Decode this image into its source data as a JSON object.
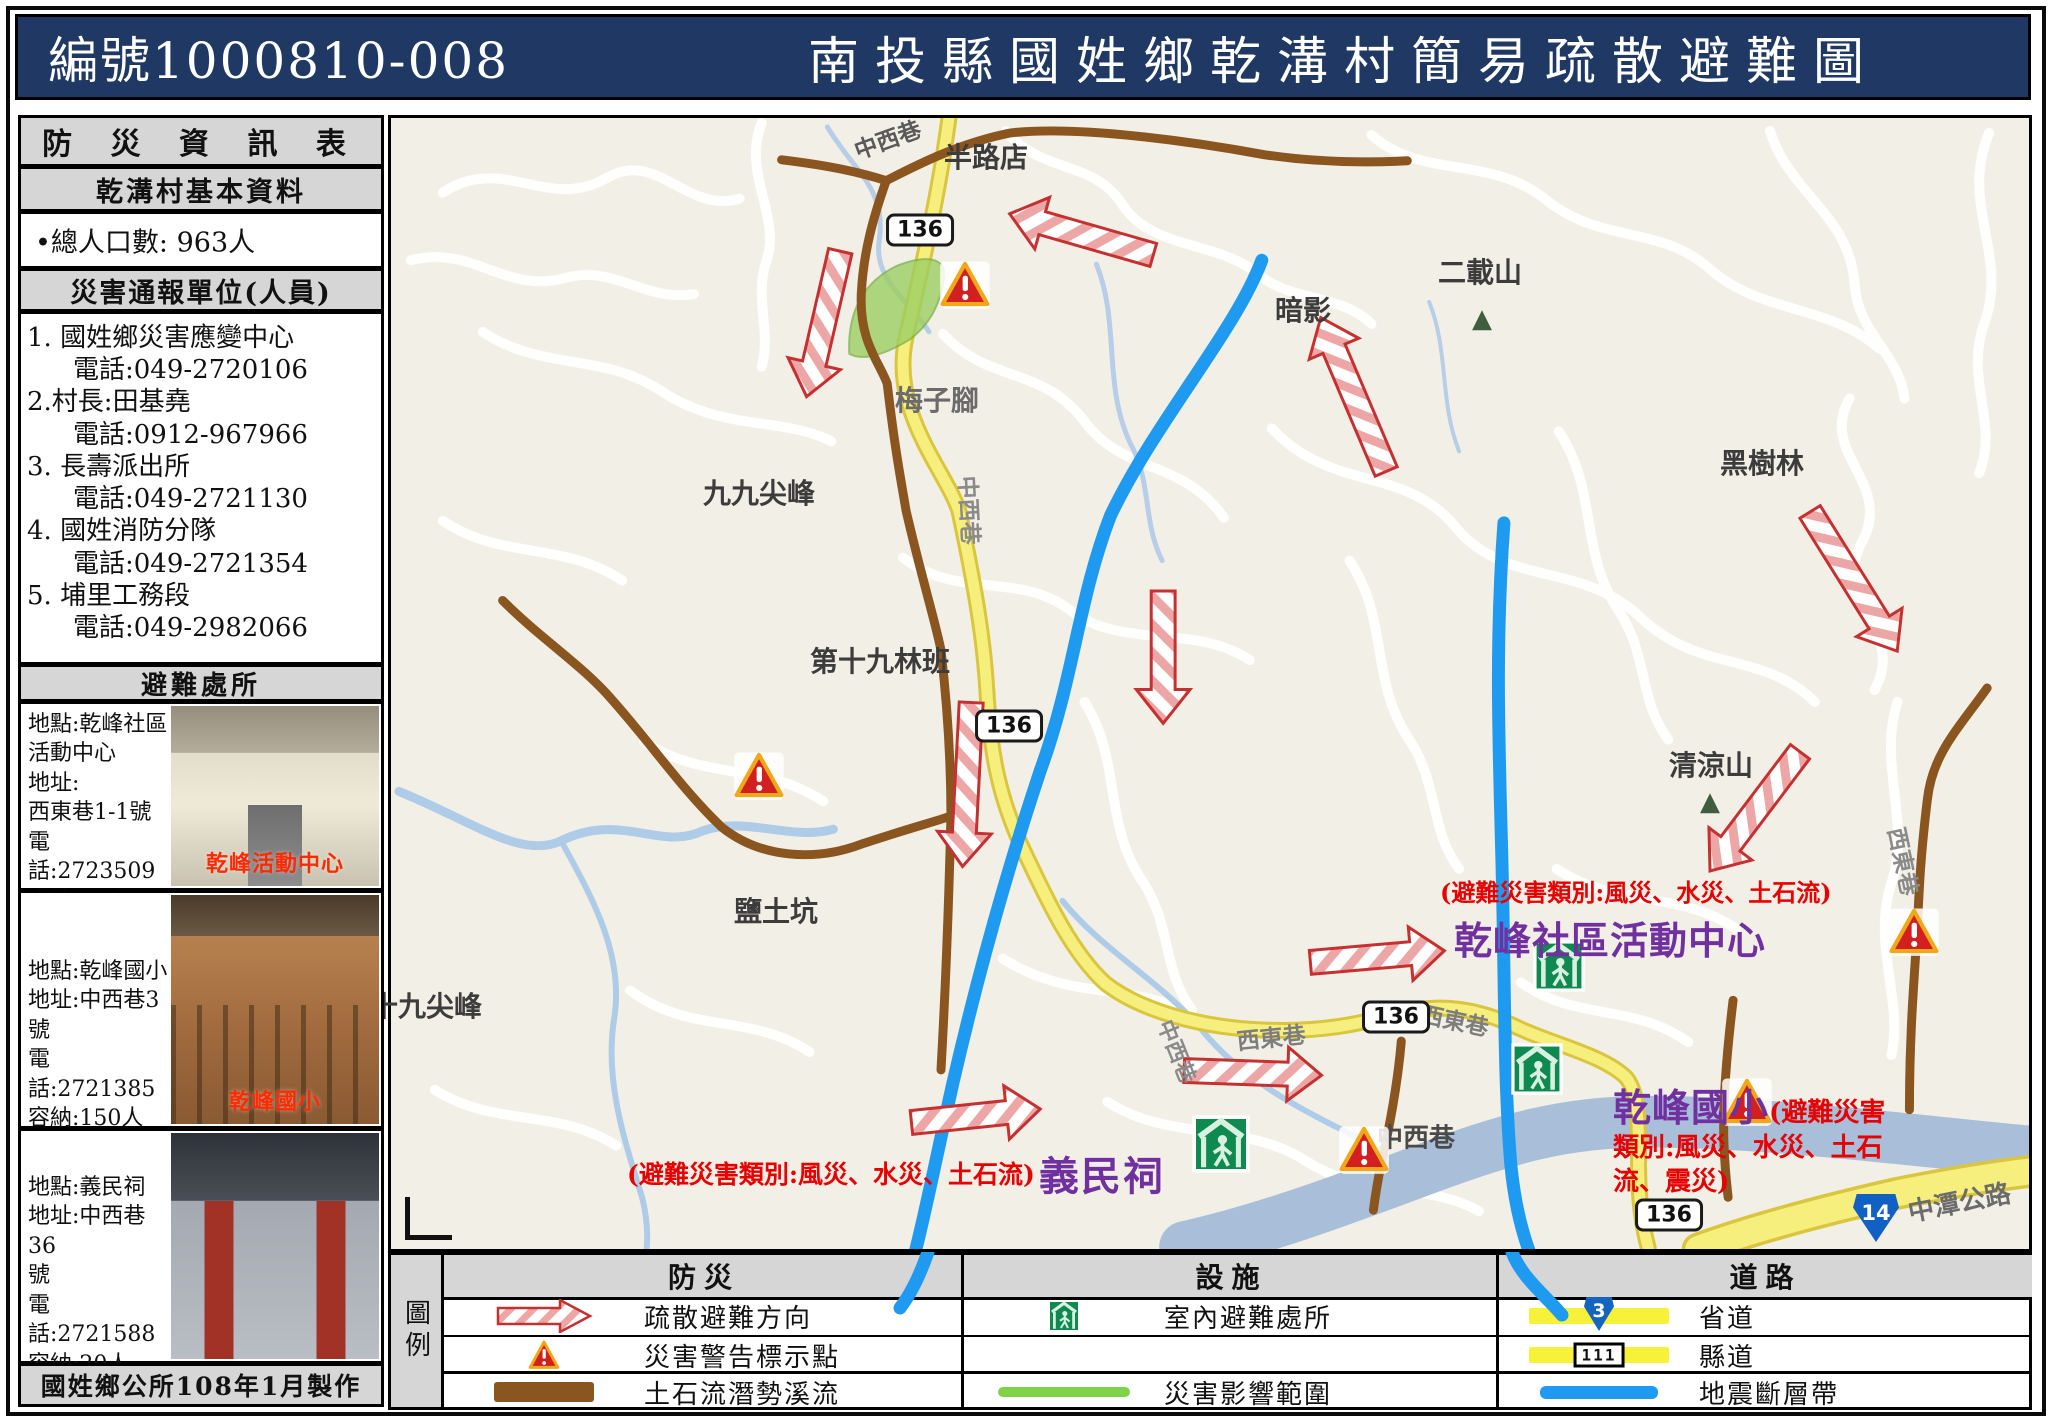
{
  "header": {
    "code": "編號1000810-008",
    "title": "南投縣國姓鄉乾溝村簡易疏散避難圖"
  },
  "sidebar": {
    "title": "防 災 資 訊 表",
    "basic_header": "乾溝村基本資料",
    "population": "•總人口數: 963人",
    "contacts_header": "災害通報單位(人員)",
    "contacts": [
      {
        "name": "1. 國姓鄉災害應變中心",
        "phone": "電話:049-2720106"
      },
      {
        "name": "2.村長:田基堯",
        "phone": "電話:0912-967966"
      },
      {
        "name": "3. 長壽派出所",
        "phone": "電話:049-2721130"
      },
      {
        "name": "4. 國姓消防分隊",
        "phone": "電話:049-2721354"
      },
      {
        "name": "5. 埔里工務段",
        "phone": "電話:049-2982066"
      }
    ],
    "shelters_header": "避難處所",
    "shelters": [
      {
        "lines": [
          "地點:乾峰社區",
          "活動中心",
          "地址:",
          "西東巷1-1號",
          "電話:2723509",
          "容納:50人",
          "管理人:田基堯"
        ],
        "photo_caption": "乾峰活動中心"
      },
      {
        "lines": [
          "地點:乾峰國小",
          "地址:中西巷3號",
          "電話:2721385",
          "容納:150人",
          "管理人:林秋榮"
        ],
        "photo_caption": "乾峰國小"
      },
      {
        "lines": [
          "地點:義民祠",
          "地址:中西巷36",
          "號",
          "電話:2721588",
          "容納:20人",
          "管理人:田基堯"
        ],
        "photo_caption": ""
      }
    ],
    "footer": "國姓鄉公所108年1月製作"
  },
  "map": {
    "labels": [
      {
        "t": "中西巷",
        "x": 884,
        "y": 135,
        "s": 23,
        "c": "#5a5a5a",
        "r": -20
      },
      {
        "t": "半路店",
        "x": 983,
        "y": 153,
        "s": 28,
        "c": "#3c3c3c",
        "r": 0
      },
      {
        "t": "二載山",
        "x": 1477,
        "y": 268,
        "s": 28,
        "c": "#3c3c3c",
        "r": 0
      },
      {
        "t": "暗影",
        "x": 1300,
        "y": 306,
        "s": 28,
        "c": "#3c3c3c",
        "r": 0
      },
      {
        "t": "黑樹林",
        "x": 1759,
        "y": 459,
        "s": 28,
        "c": "#3c3c3c",
        "r": 0
      },
      {
        "t": "梅子腳",
        "x": 934,
        "y": 396,
        "s": 28,
        "c": "#6b6b6b",
        "r": 0
      },
      {
        "t": "九九尖峰",
        "x": 756,
        "y": 489,
        "s": 28,
        "c": "#3c3c3c",
        "r": 0
      },
      {
        "t": "第十九林班",
        "x": 877,
        "y": 657,
        "s": 28,
        "c": "#3c3c3c",
        "r": 0
      },
      {
        "t": "清涼山",
        "x": 1708,
        "y": 761,
        "s": 28,
        "c": "#3c3c3c",
        "r": 0
      },
      {
        "t": "鹽土坑",
        "x": 773,
        "y": 907,
        "s": 28,
        "c": "#3c3c3c",
        "r": 0
      },
      {
        "t": "十九尖峰",
        "x": 423,
        "y": 1002,
        "s": 28,
        "c": "#3c3c3c",
        "r": 0
      },
      {
        "t": "西東巷",
        "x": 1902,
        "y": 858,
        "s": 23,
        "c": "#8a8a8a",
        "r": 78
      },
      {
        "t": "中西巷",
        "x": 968,
        "y": 507,
        "s": 23,
        "c": "#8a8a8a",
        "r": 87
      },
      {
        "t": "中西巷",
        "x": 1175,
        "y": 1048,
        "s": 22,
        "c": "#8a8a8a",
        "r": 68
      },
      {
        "t": "西東巷",
        "x": 1268,
        "y": 1033,
        "s": 23,
        "c": "#7d7d7d",
        "r": -6
      },
      {
        "t": "西東巷",
        "x": 1452,
        "y": 1016,
        "s": 23,
        "c": "#7d7d7d",
        "r": 12
      },
      {
        "t": "中西巷",
        "x": 1413,
        "y": 1133,
        "s": 26,
        "c": "#4a4a4a",
        "r": 0
      },
      {
        "t": "中潭公路",
        "x": 1956,
        "y": 1198,
        "s": 26,
        "c": "#6b6b6b",
        "r": -11
      }
    ],
    "mountains": [
      {
        "x": 1479,
        "y": 316
      },
      {
        "x": 1707,
        "y": 799
      }
    ],
    "shields": [
      {
        "t": "136",
        "x": 917,
        "y": 227
      },
      {
        "t": "136",
        "x": 1006,
        "y": 723
      },
      {
        "t": "136",
        "x": 1393,
        "y": 1014
      },
      {
        "t": "136",
        "x": 1666,
        "y": 1212
      },
      {
        "t": "14",
        "x": 1873,
        "y": 1215,
        "blue": true
      }
    ],
    "warnings": [
      {
        "x": 962,
        "y": 283
      },
      {
        "x": 756,
        "y": 774
      },
      {
        "x": 1911,
        "y": 930
      },
      {
        "x": 1744,
        "y": 1100
      },
      {
        "x": 1361,
        "y": 1148
      }
    ],
    "shelter_icons": [
      {
        "x": 1218,
        "y": 1143,
        "s": 58
      },
      {
        "x": 1556,
        "y": 965,
        "s": 52
      },
      {
        "x": 1534,
        "y": 1068,
        "s": 52
      }
    ],
    "arrows": [
      {
        "x": 1081,
        "y": 232,
        "a": 196,
        "l": 150
      },
      {
        "x": 822,
        "y": 322,
        "a": 103,
        "l": 150
      },
      {
        "x": 1354,
        "y": 393,
        "a": -113,
        "l": 168
      },
      {
        "x": 1856,
        "y": 581,
        "a": 58,
        "l": 165
      },
      {
        "x": 1757,
        "y": 812,
        "a": 127,
        "l": 150
      },
      {
        "x": 966,
        "y": 785,
        "a": 93,
        "l": 165
      },
      {
        "x": 1163,
        "y": 657,
        "a": 90,
        "l": 133
      },
      {
        "x": 975,
        "y": 1118,
        "a": -6,
        "l": 130
      },
      {
        "x": 1253,
        "y": 1075,
        "a": 2,
        "l": 138
      },
      {
        "x": 1378,
        "y": 958,
        "a": -5,
        "l": 135
      }
    ],
    "debris_streams": [
      "M780,157 C830,163 860,170 885,178 C872,215 862,250 860,292 C858,340 878,360 886,382 C894,450 900,480 905,510 C920,575 934,620 940,650 C948,720 950,770 950,816 C948,900 944,1000 940,1072",
      "M885,178 C920,160 960,140 1010,130 C1080,122 1200,140 1265,152 C1320,160 1370,160 1408,158",
      "M500,600 C540,640 580,665 610,700 C650,745 680,790 720,828 C760,860 815,862 860,845 C905,830 935,822 949,817",
      "M1990,688 C1960,730 1935,755 1930,800 C1924,850 1922,880 1920,930 C1916,990 1912,1040 1912,1112",
      "M1402,1043 C1398,1090 1390,1130 1382,1165 C1377,1190 1375,1205 1374,1213",
      "M1735,1002 C1728,1060 1724,1110 1726,1150 C1727,1175 1729,1190 1730,1200"
    ],
    "fault_lines": [
      "M1262,258 C1235,330 1155,420 1110,515 C1078,598 1073,680 1040,770 C1005,875 975,985 952,1085 C935,1160 920,1240 900,1308",
      "M1505,522 C1496,645 1500,745 1503,862 C1506,990 1505,1085 1512,1168 C1520,1250 1545,1290 1562,1315"
    ],
    "fault_tails": [
      "M928,1252 C920,1275 910,1295 900,1308",
      "M1512,1252 C1522,1278 1545,1295 1562,1315"
    ],
    "impact_zone": "M848,352 C846,310 862,280 895,264 C925,252 945,255 943,275 C940,300 930,322 908,338 C885,352 862,360 848,352 Z",
    "annotations": {
      "yiminci": {
        "red": "(避難災害類別:風災、水災、土石流)",
        "purple": "義民祠"
      },
      "activity_center": {
        "red": "(避難災害類別:風災、水災、土石流)",
        "purple": "乾峰社區活動中心"
      },
      "school": {
        "purple": "乾峰國小",
        "red": "(避難災害類別:風災、水災、土石流、震災)"
      }
    }
  },
  "legend": {
    "key": "圖例",
    "col1": {
      "header": "防災",
      "r1": "疏散避難方向",
      "r2": "災害警告標示點",
      "r3": "土石流潛勢溪流"
    },
    "col2": {
      "header": "設施",
      "r1": "室內避難處所",
      "r2": "",
      "r3": "災害影響範圍"
    },
    "col3": {
      "header": "道路",
      "r1": "省道",
      "r2": "縣道",
      "r3": "地震斷層帶",
      "badge1": "3",
      "badge2": "111"
    }
  },
  "colors": {
    "navy": "#1f3864",
    "red": "#e60000",
    "purple": "#7030a0",
    "brown": "#8a551e",
    "fault": "#1e9bf0",
    "shelter_green": "#0e8a50",
    "road_yellow": "#f6ee7d"
  }
}
